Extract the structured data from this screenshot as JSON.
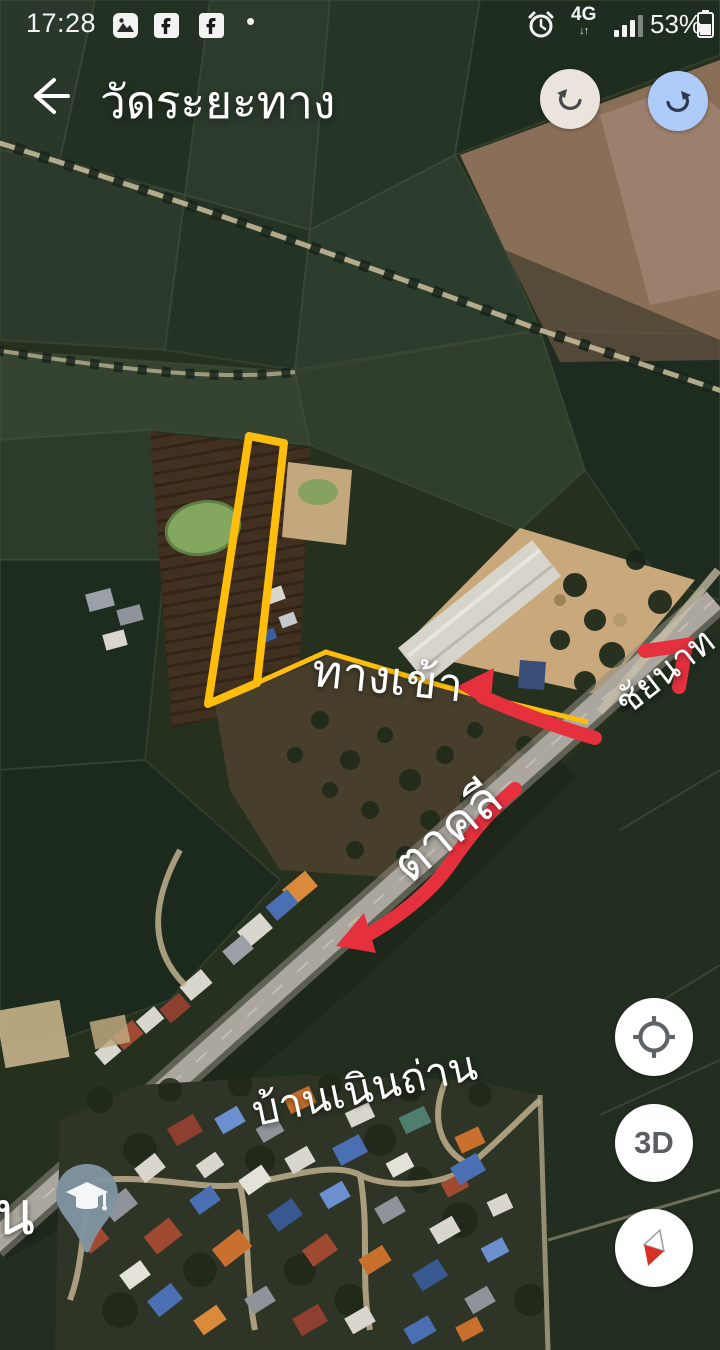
{
  "status_bar": {
    "time": "17:28",
    "notification_dot": "•",
    "network": "4G",
    "battery_percent": "53%",
    "icons": [
      "gallery-icon",
      "facebook-icon",
      "facebook-icon",
      "alarm-icon",
      "signal-strength-icon",
      "battery-icon"
    ]
  },
  "header": {
    "title": "วัดระยะทาง",
    "back_icon": "arrow-left",
    "undo_icon": "undo-arrow",
    "redo_icon": "redo-arrow"
  },
  "map": {
    "labels": {
      "entrance": "ทางเข้า",
      "direction_northeast": "ชัยนาท",
      "direction_southwest": "ตาคลี",
      "village": "บ้านเนินถ่าน",
      "edge_partial": "น"
    },
    "markers": [
      "education-place-pin"
    ],
    "annotations": [
      "measure-polygon",
      "measure-path",
      "red-arrow-entrance",
      "red-arrow-northeast",
      "red-arrow-southwest"
    ]
  },
  "controls": {
    "three_d_label": "3D",
    "my_location_icon": "crosshair",
    "compass_icon": "compass-needle"
  },
  "colors": {
    "measure_line": "#ffbe0c",
    "annotation_red": "#e5303e",
    "undo_button_bg": "#eae4dc",
    "redo_button_bg": "#aecbfa",
    "pin_fill": "#8095a1",
    "highway": "#aba79e"
  }
}
